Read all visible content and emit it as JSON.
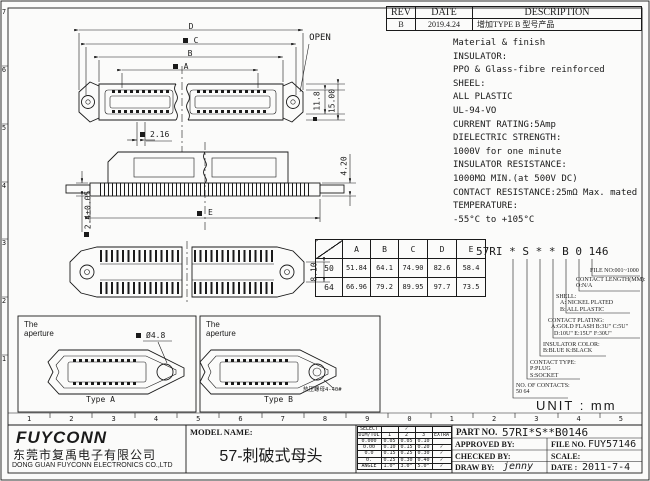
{
  "frame": {
    "left_ruler": [
      "7",
      "6",
      "5",
      "4",
      "3",
      "2",
      "1"
    ],
    "bottom_ruler": [
      "1",
      "2",
      "3",
      "4",
      "5",
      "6",
      "7",
      "8",
      "9",
      "0",
      "1",
      "2",
      "3",
      "4",
      "5"
    ]
  },
  "rev_table": {
    "headers": [
      "REV",
      "DATE",
      "DESCRIPTION"
    ],
    "row": {
      "rev": "B",
      "date": "2019.4.24",
      "desc": "增加TYPE B 型号产品"
    }
  },
  "material_notes": {
    "lines": [
      "Material & finish",
      "INSULATOR:",
      "PPO & Glass-fibre reinforced",
      "SHEEL:",
      "ALL PLASTIC",
      "UL-94-VO",
      "CURRENT RATING:5Amp",
      "DIELECTRIC STRENGTH:",
      "1000V for one minute",
      "INSULATOR RESISTANCE:",
      "1000MΩ MIN.(at 500V DC)",
      "CONTACT RESISTANCE:25mΩ Max. mated",
      "TEMPERATURE:",
      "-55°C to +105°C"
    ]
  },
  "dim_table": {
    "col_headers": [
      "A",
      "B",
      "C",
      "D",
      "E"
    ],
    "rows": [
      {
        "label": "50",
        "values": [
          "51.84",
          "64.1",
          "74.90",
          "82.6",
          "58.4"
        ]
      },
      {
        "label": "64",
        "values": [
          "66.96",
          "79.2",
          "89.95",
          "97.7",
          "73.5"
        ]
      }
    ]
  },
  "part_code": {
    "text": "57RI * S * * B 0 146",
    "callouts": {
      "file_no": {
        "l1": "FILE NO:001~1000"
      },
      "contact_length": {
        "l1": "CONTACT LENGTH(MM):",
        "l2": "O:N/A"
      },
      "shell": {
        "l1": "SHELL:",
        "l2": "A: NICKEL PLATED",
        "l3": "B: ALL PLASTIC"
      },
      "plating": {
        "l1": "CONTACT PLATING:",
        "l2": "A:GOLD FLASH  B:3U\" C:5U\"",
        "l3": "D:10U\" E:15U\" F:30U\""
      },
      "color": {
        "l1": "INSULATOR COLOR:",
        "l2": "B:BLUE  K:BLACK"
      },
      "type": {
        "l1": "CONTACT TYPE:",
        "l2": "P:PLUG",
        "l3": "S:SOCKET"
      },
      "contacts": {
        "l1": "NO. OF CONTACTS:",
        "l2": "50  64"
      }
    }
  },
  "dims": {
    "d": "D",
    "c": "C",
    "b": "B",
    "a": "A",
    "open": "OPEN",
    "d216": "2.16",
    "d118": "11.8",
    "d1500": "15.00",
    "d420": "4.20",
    "d24": "2.4±0.05",
    "e": "E",
    "d810": "8.10",
    "dia48": "Ø4.8",
    "nut": "热压螺母4-40#"
  },
  "panels": {
    "aperture": "The\naperture",
    "type_a": "Type A",
    "type_b": "Type B"
  },
  "unit_note": "UNIT : mm",
  "tolerance_table": {
    "select": "SELECT",
    "dim_tol": "DIM/TOL",
    "check": "✓",
    "cols": [
      "1",
      "2",
      "3",
      "EXTRA"
    ],
    "rows": [
      [
        "0.000",
        "0.05",
        "0.05",
        "0.10",
        ""
      ],
      [
        "0.00",
        "0.10",
        "0.15",
        "0.20",
        "✓"
      ],
      [
        "0.0",
        "0.15",
        "0.25",
        "0.30",
        "✓"
      ],
      [
        "0.",
        "0.25",
        "0.30",
        "0.40",
        "✓"
      ],
      [
        "ANGLE",
        "1.0°",
        "3.0°",
        "5.0°",
        "✓"
      ]
    ]
  },
  "title_block": {
    "logo": "FUYCONN",
    "company_cn": "东莞市复禹电子有限公司",
    "company_en": "DONG GUAN FUYCONN ELECTRONICS CO.,LTD",
    "model_label": "MODEL NAME:",
    "model_name": "57-刺破式母头",
    "part_label": "PART NO.",
    "part_no": "57RI*S**B0146",
    "approved": "APPROVED BY:",
    "checked": "CHECKED BY:",
    "draw": "DRAW BY:",
    "draw_by": "jenny",
    "file_label": "FILE NO.",
    "file_no": "FUY57146",
    "scale": "SCALE:",
    "date_label": "DATE :",
    "date": "2011-7-4"
  }
}
